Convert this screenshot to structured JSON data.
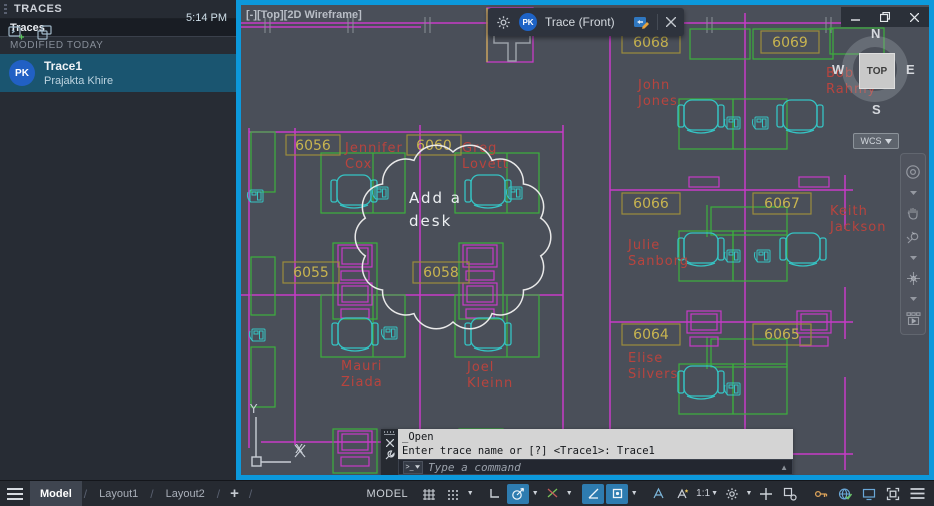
{
  "panel": {
    "title": "TRACES",
    "list_header": "Traces",
    "section_label": "MODIFIED TODAY",
    "item": {
      "avatar": "PK",
      "name": "Trace1",
      "author": "Prajakta Khire",
      "time": "5:14 PM"
    }
  },
  "window": {
    "viewport_label": "[-][Top][2D Wireframe]",
    "toolbar": {
      "avatar": "PK",
      "title": "Trace (Front)"
    },
    "viewcube": {
      "top": "TOP",
      "n": "N",
      "s": "S",
      "e": "E",
      "w": "W",
      "wcs": "WCS"
    },
    "ucs": {
      "x": "X",
      "y": "Y"
    }
  },
  "plan": {
    "rooms": [
      "6056",
      "6060",
      "6068",
      "6069",
      "6055",
      "6058",
      "6066",
      "6067",
      "6064",
      "6065"
    ],
    "names": [
      {
        "l1": "Jennifer",
        "l2": "Cox"
      },
      {
        "l1": "Greg",
        "l2": "Lovett"
      },
      {
        "l1": "John",
        "l2": "Jones"
      },
      {
        "l1": "Bob",
        "l2": "Rahmy"
      },
      {
        "l1": "Julie",
        "l2": "Sanborg"
      },
      {
        "l1": "Keith",
        "l2": "Jackson"
      },
      {
        "l1": "Mauri",
        "l2": "Ziada"
      },
      {
        "l1": "Joel",
        "l2": "Kleinn"
      },
      {
        "l1": "Elise",
        "l2": "Silvers"
      }
    ],
    "annotation": {
      "l1": "Add a",
      "l2": "desk"
    }
  },
  "command": {
    "history_line1": "_Open",
    "history_line2": "Enter trace name or [?] <Trace1>: Trace1",
    "placeholder": "Type a command"
  },
  "statusbar": {
    "tabs": [
      "Model",
      "Layout1",
      "Layout2"
    ],
    "add_tab": "+",
    "model_label": "MODEL",
    "scale": "1:1"
  },
  "colors": {
    "trace_border": "#0c99dc",
    "canvas": "#4a4f59",
    "wall": "#c73bc7",
    "desk": "#3cb13c",
    "chair": "#35c4c4",
    "room_label": "#c8b450",
    "name_text": "#b8443e",
    "cloud": "#e9e9e9",
    "selection": "#1a5570",
    "active_button": "#2e7cb0",
    "avatar": "#1e63c6"
  }
}
